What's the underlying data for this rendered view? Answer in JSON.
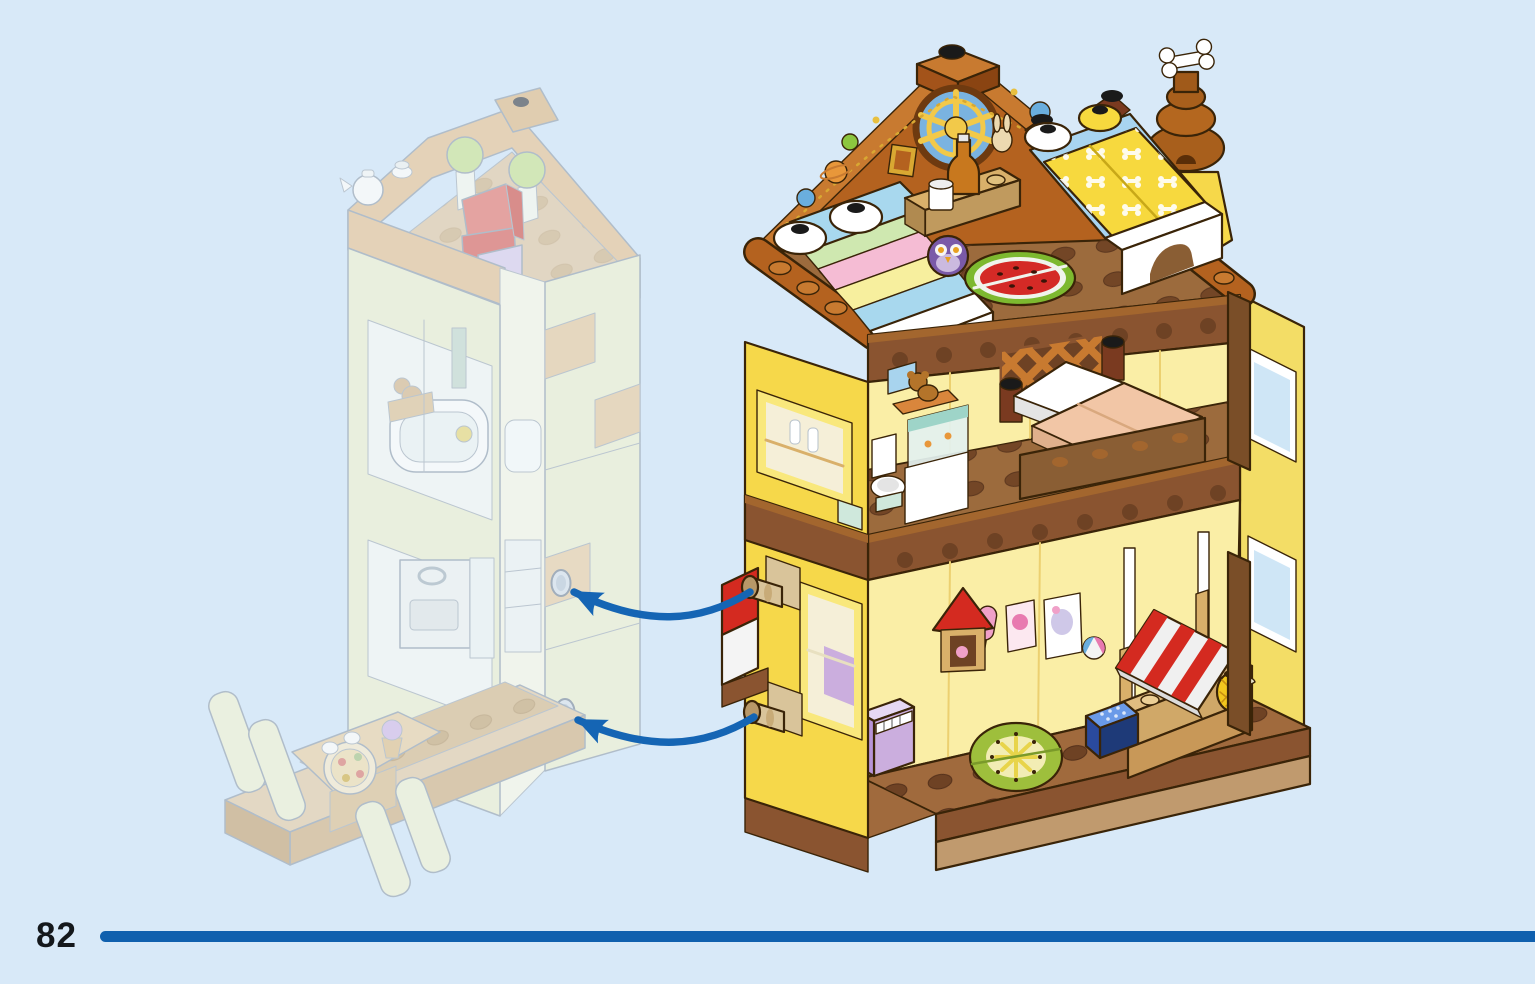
{
  "page": {
    "number": "82"
  },
  "colors": {
    "background": "#d8e9f8",
    "footer_rule": "#1060ae",
    "arrow": "#1565b4",
    "page_number": "#14181c"
  },
  "illustration": {
    "main_model": {
      "name": "three-storey-house-module",
      "floors": [
        "attic-bedroom",
        "bedroom-bathroom",
        "ground-floor-market"
      ],
      "connection_pins": 2
    },
    "ghost_model": {
      "name": "faded-target-module",
      "rooms": [
        "roof-terrace",
        "bathroom",
        "kitchen",
        "dining-booth"
      ],
      "connection_holes": 2
    },
    "arrows": {
      "count": 2,
      "name": "attach-direction-arrows"
    }
  }
}
